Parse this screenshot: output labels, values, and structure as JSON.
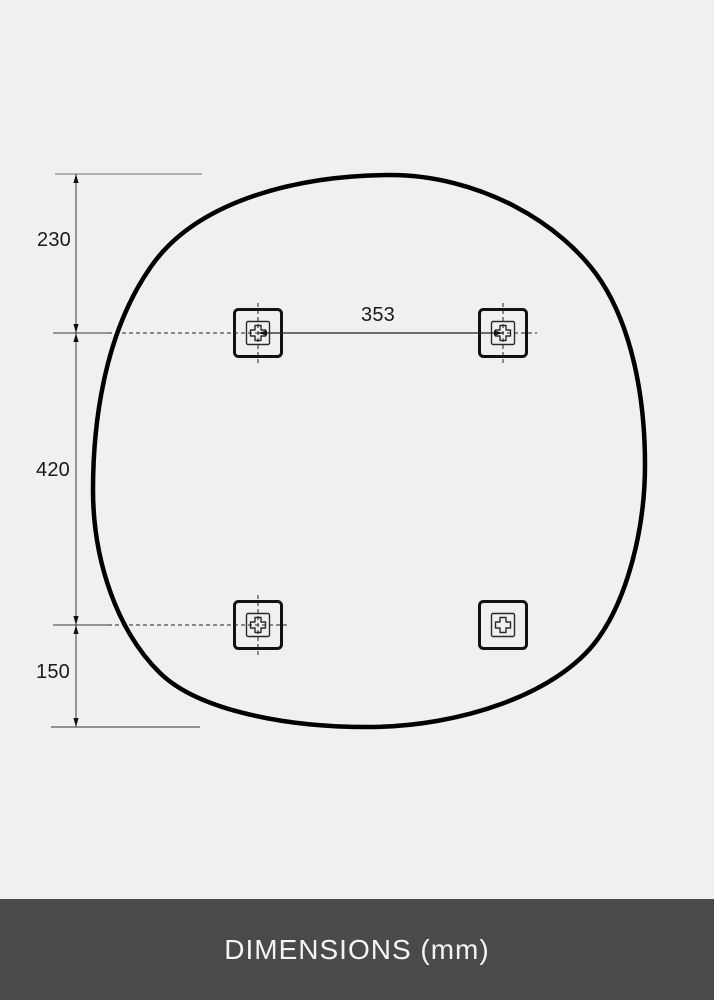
{
  "page": {
    "background_color": "#f0f0f1"
  },
  "diagram": {
    "description": "Dimension drawing of an organic rounded-square mirror outline with four wall-mount brackets",
    "unit": "mm",
    "labels": {
      "top_edge_to_upper_brackets": "230",
      "upper_to_lower_brackets": "420",
      "lower_brackets_to_bottom_edge": "150",
      "upper_bracket_spacing": "353"
    },
    "brackets": [
      {
        "position": "top-left",
        "icon": "mount-bracket-icon",
        "crosshair": true
      },
      {
        "position": "top-right",
        "icon": "mount-bracket-icon",
        "crosshair": true
      },
      {
        "position": "bottom-left",
        "icon": "mount-bracket-icon",
        "crosshair": true
      },
      {
        "position": "bottom-right",
        "icon": "mount-bracket-icon",
        "crosshair": false
      }
    ],
    "colors": {
      "outline": "#000000",
      "dimension_lines": "#3a3a3a",
      "extension_line_top": "#b0b0b0",
      "extension_line_bottom": "#5a5a5a",
      "label_text": "#1a1a1a"
    }
  },
  "footer": {
    "label": "DIMENSIONS (mm)",
    "background_color": "#4a4a4a",
    "text_color": "#f4f4f4"
  }
}
